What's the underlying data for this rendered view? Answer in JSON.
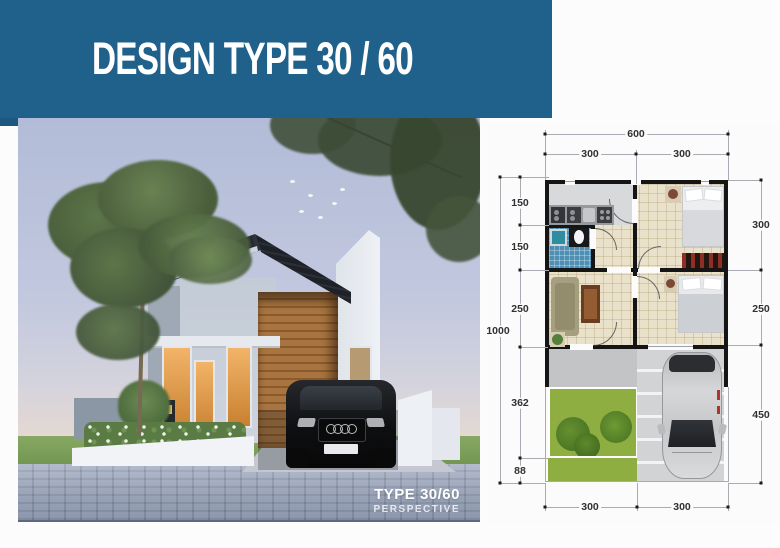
{
  "header": {
    "title": "DESIGN TYPE 30 / 60"
  },
  "render": {
    "caption_title": "TYPE 30/60",
    "caption_subtitle": "PERSPECTIVE"
  },
  "floor_plan": {
    "dimensions": {
      "top_total": "600",
      "top_segments": [
        "300",
        "300"
      ],
      "left_segments": [
        "150",
        "150",
        "250",
        "362",
        "88"
      ],
      "left_total": "1000",
      "right_segments": [
        "300",
        "250",
        "450"
      ],
      "bottom_segments": [
        "300",
        "300"
      ]
    }
  },
  "colors": {
    "banner_blue": "#20618b",
    "garden_green": "#8fae41",
    "bathroom_blue": "#4e8fb3",
    "wood_brown": "#a8743f",
    "roof_charcoal": "#262a31"
  }
}
